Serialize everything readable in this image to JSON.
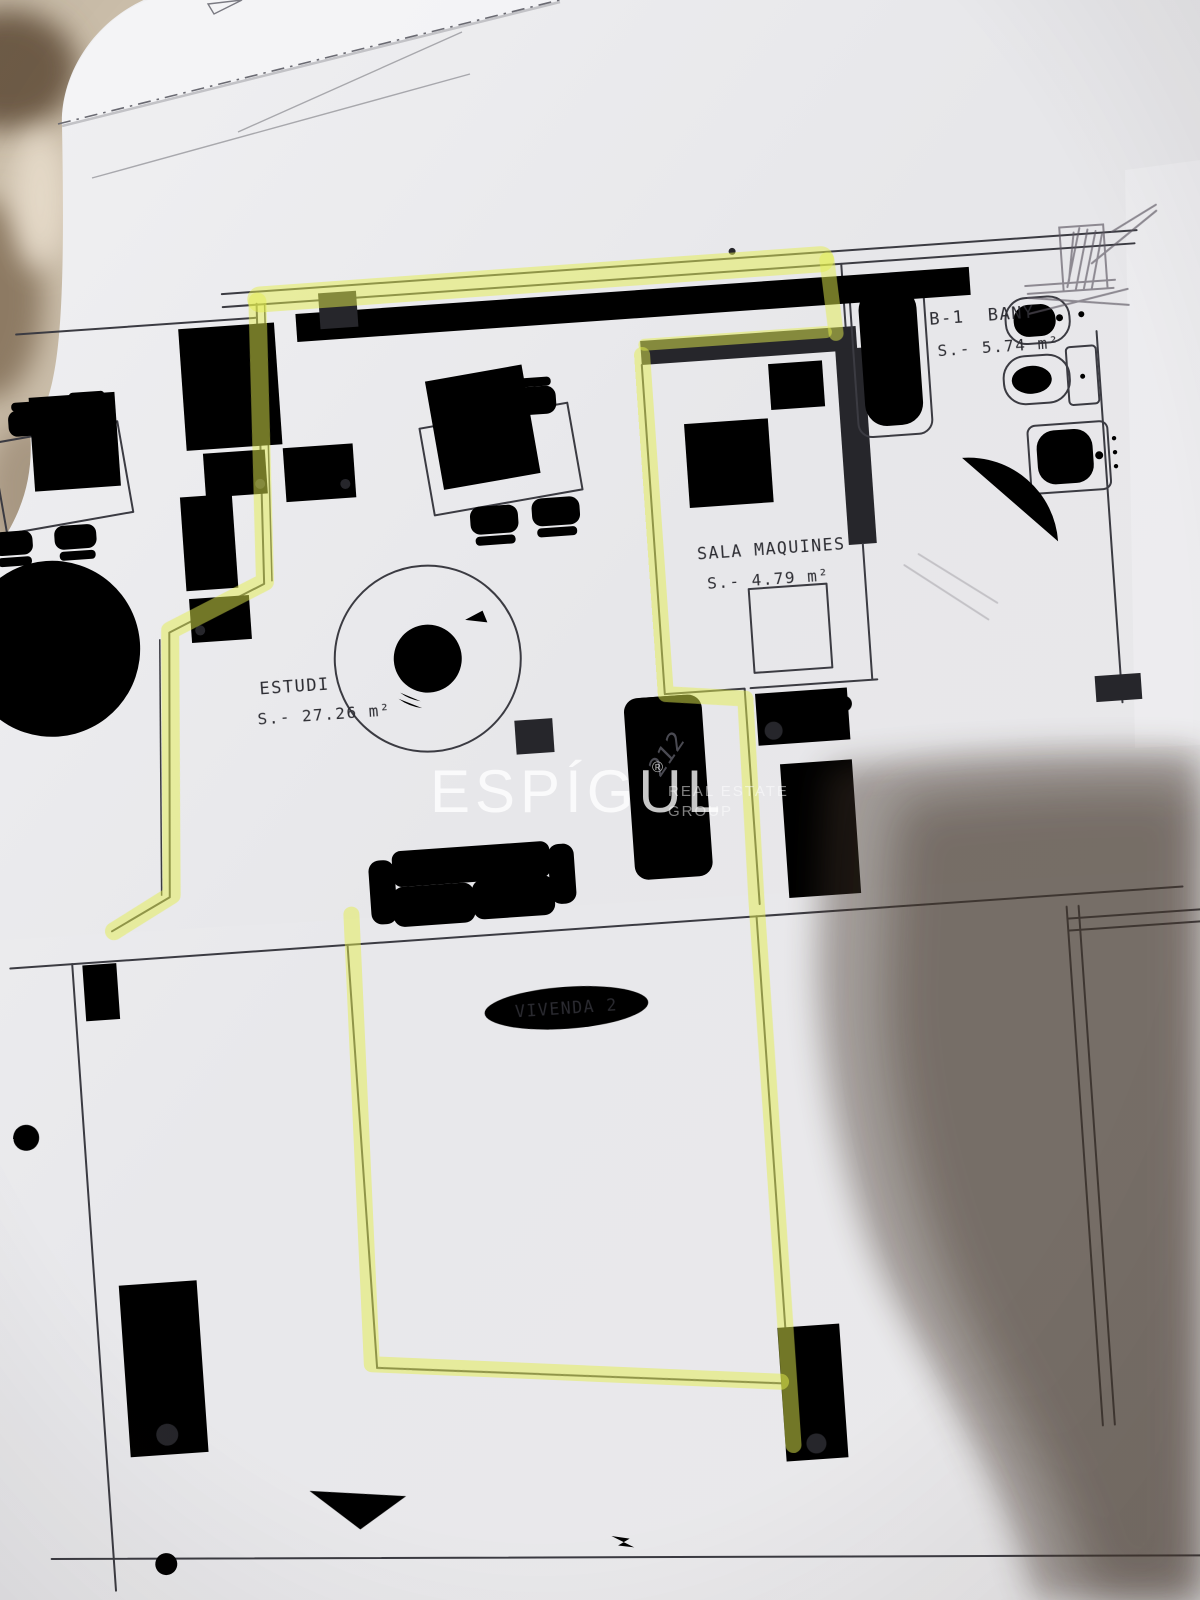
{
  "photo": {
    "watermark": {
      "brand": "ESPÍGUL",
      "registered": "®",
      "tagline_line1": "REAL ESTATE",
      "tagline_line2": "GROUP"
    },
    "handwritten_note": "212"
  },
  "floor_plan": {
    "rooms": {
      "bany": {
        "label": "B-1  BANY",
        "area": "S.- 5.74 m²"
      },
      "sala_maquines": {
        "label": "SALA MAQUINES",
        "area": "S.- 4.79 m²"
      },
      "estudi": {
        "label": "ESTUDI",
        "area": "S.- 27.26 m²"
      },
      "vivenda_2": {
        "label": "VIVENDA 2"
      }
    }
  },
  "colors": {
    "highlighter": "#e3ee4e",
    "ink": "#3b3b42",
    "paper": "#e9e9ec",
    "fabric": "#cabda9",
    "shadow": "#42352a"
  }
}
